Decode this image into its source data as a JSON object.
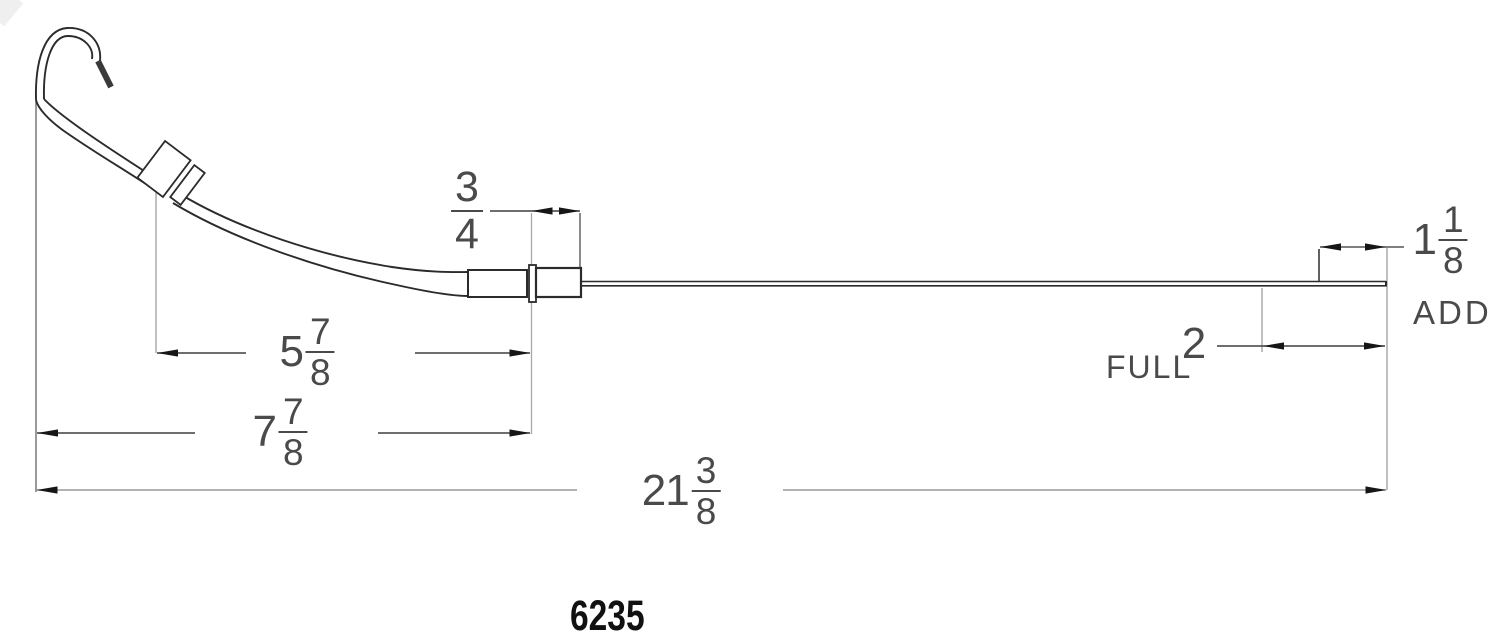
{
  "drawing": {
    "type": "engine-oil-dipstick-dimension-drawing",
    "part_number": "6235",
    "marks": {
      "full_label": "FULL",
      "add_label": "ADD"
    },
    "dimensions": {
      "tube_end_offset": {
        "num": "3",
        "den": "4"
      },
      "collar_to_tube_end": {
        "whole": "5",
        "num": "7",
        "den": "8"
      },
      "hook_to_tube_end": {
        "whole": "7",
        "num": "7",
        "den": "8"
      },
      "overall_length": {
        "whole": "21",
        "num": "3",
        "den": "8"
      },
      "tip_to_add_mark": {
        "whole": "1",
        "num": "1",
        "den": "8"
      },
      "tip_to_full_mark": {
        "value": "2"
      }
    },
    "colors": {
      "part_line": "#2b2b2b",
      "dim_line": "#3f3f3f",
      "long_dim_line": "#9a9a9a",
      "extension_line": "#9f9f9f",
      "arrow": "#161616",
      "label_text": "#4a4a4a",
      "part_number_text": "#111111",
      "background": "#ffffff"
    }
  }
}
